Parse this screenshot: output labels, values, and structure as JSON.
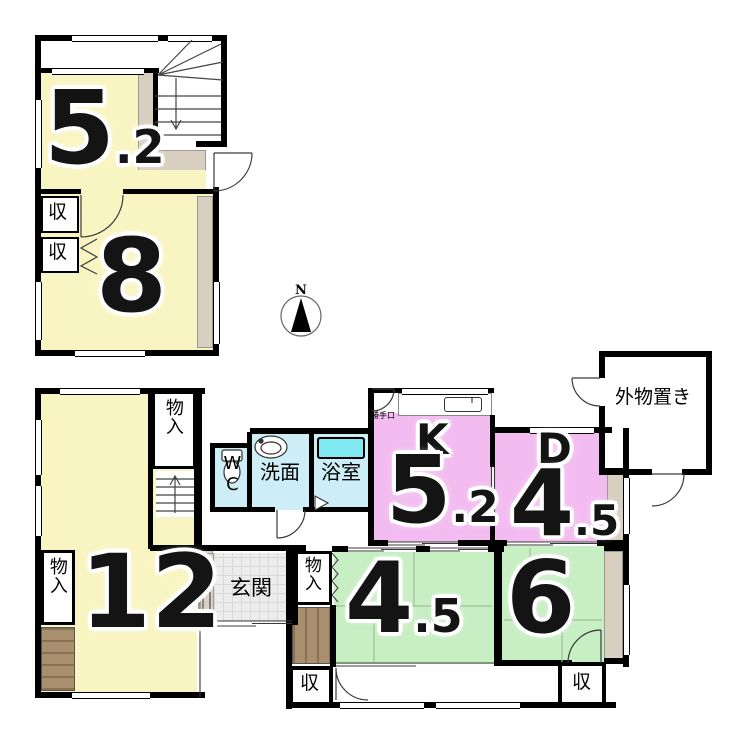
{
  "colors": {
    "room_yellow": "#f9f5c2",
    "room_pink": "#f3bcf0",
    "room_green": "#c8eec3",
    "wet_blue": "#cdeef7",
    "tub_cyan": "#80e8f1",
    "balcony_tan": "#d9cfc0",
    "deck_brown": "#a98f6d",
    "wall_black": "#000000"
  },
  "compass": {
    "north_label": "N"
  },
  "floor2": {
    "room_5_2": {
      "value_int": "5",
      "value_dec": ".2"
    },
    "room_8": {
      "value": "8"
    },
    "closet_top": {
      "label": "収"
    },
    "closet_bottom": {
      "label": "収"
    }
  },
  "floor1": {
    "room_12": {
      "value": "12"
    },
    "closet_hall": {
      "label": "物入"
    },
    "closet_west": {
      "label": "物入"
    },
    "wc": {
      "label": "WC"
    },
    "washroom": {
      "label": "洗面"
    },
    "bathroom": {
      "label": "浴室"
    },
    "back_door": {
      "label": "勝手口"
    },
    "kitchen": {
      "letter": "K",
      "value_int": "5",
      "value_dec": ".2"
    },
    "dining": {
      "letter": "D",
      "value_int": "4",
      "value_dec": ".5"
    },
    "outdoor_storage": {
      "label": "外物置き"
    },
    "entrance": {
      "label": "玄関"
    },
    "closet_45": {
      "label": "物入"
    },
    "room_4_5": {
      "value_int": "4",
      "value_dec": ".5"
    },
    "room_6": {
      "value": "6"
    },
    "storage_sw": {
      "label": "収"
    },
    "storage_se": {
      "label": "収"
    }
  }
}
